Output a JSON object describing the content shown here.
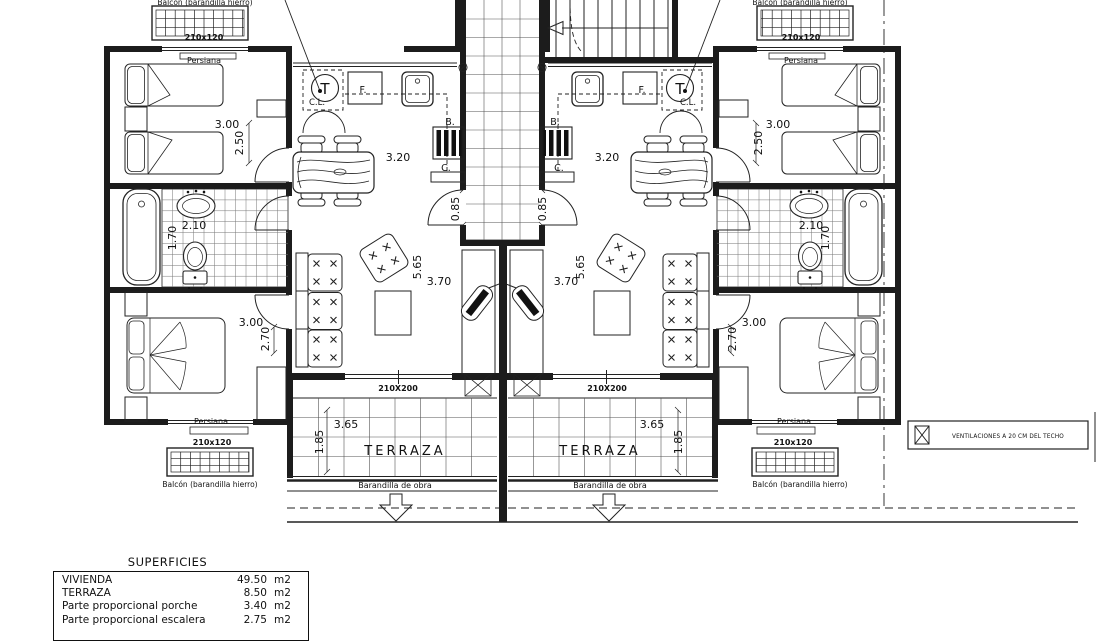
{
  "plan": {
    "labels": {
      "balcon_caption": "Balcón (barandilla hierro)",
      "persiana": "Persiana",
      "terraza": "TERRAZA",
      "barandilla": "Barandilla de obra",
      "window_bedroom": "210x120",
      "window_living": "210X200",
      "termo": "T",
      "closet": "C.L.",
      "fridge": "F.",
      "boiler": "B.",
      "counter": "C."
    },
    "dimensions": {
      "bedroom1_width": "3.00",
      "bedroom1_depth": "2.50",
      "kitchen_width": "3.20",
      "bathroom_width": "2.10",
      "bathroom_depth": "1.70",
      "living_length": "5.65",
      "living_width": "3.70",
      "bedroom2_width": "3.00",
      "bedroom2_depth": "2.70",
      "entry_width": "0.85",
      "terraza_width": "3.65",
      "terraza_depth": "1.85"
    }
  },
  "legend": {
    "ventilation_note": "VENTILACIONES A 20 CM DEL TECHO"
  },
  "superficies": {
    "title": "SUPERFICIES",
    "rows": [
      {
        "label": "VIVIENDA",
        "value": "49.50",
        "unit": "m2"
      },
      {
        "label": "TERRAZA",
        "value": "8.50",
        "unit": "m2"
      },
      {
        "label": "Parte proporcional porche",
        "value": "3.40",
        "unit": "m2"
      },
      {
        "label": "Parte proporcional escalera",
        "value": "2.75",
        "unit": "m2"
      }
    ]
  }
}
